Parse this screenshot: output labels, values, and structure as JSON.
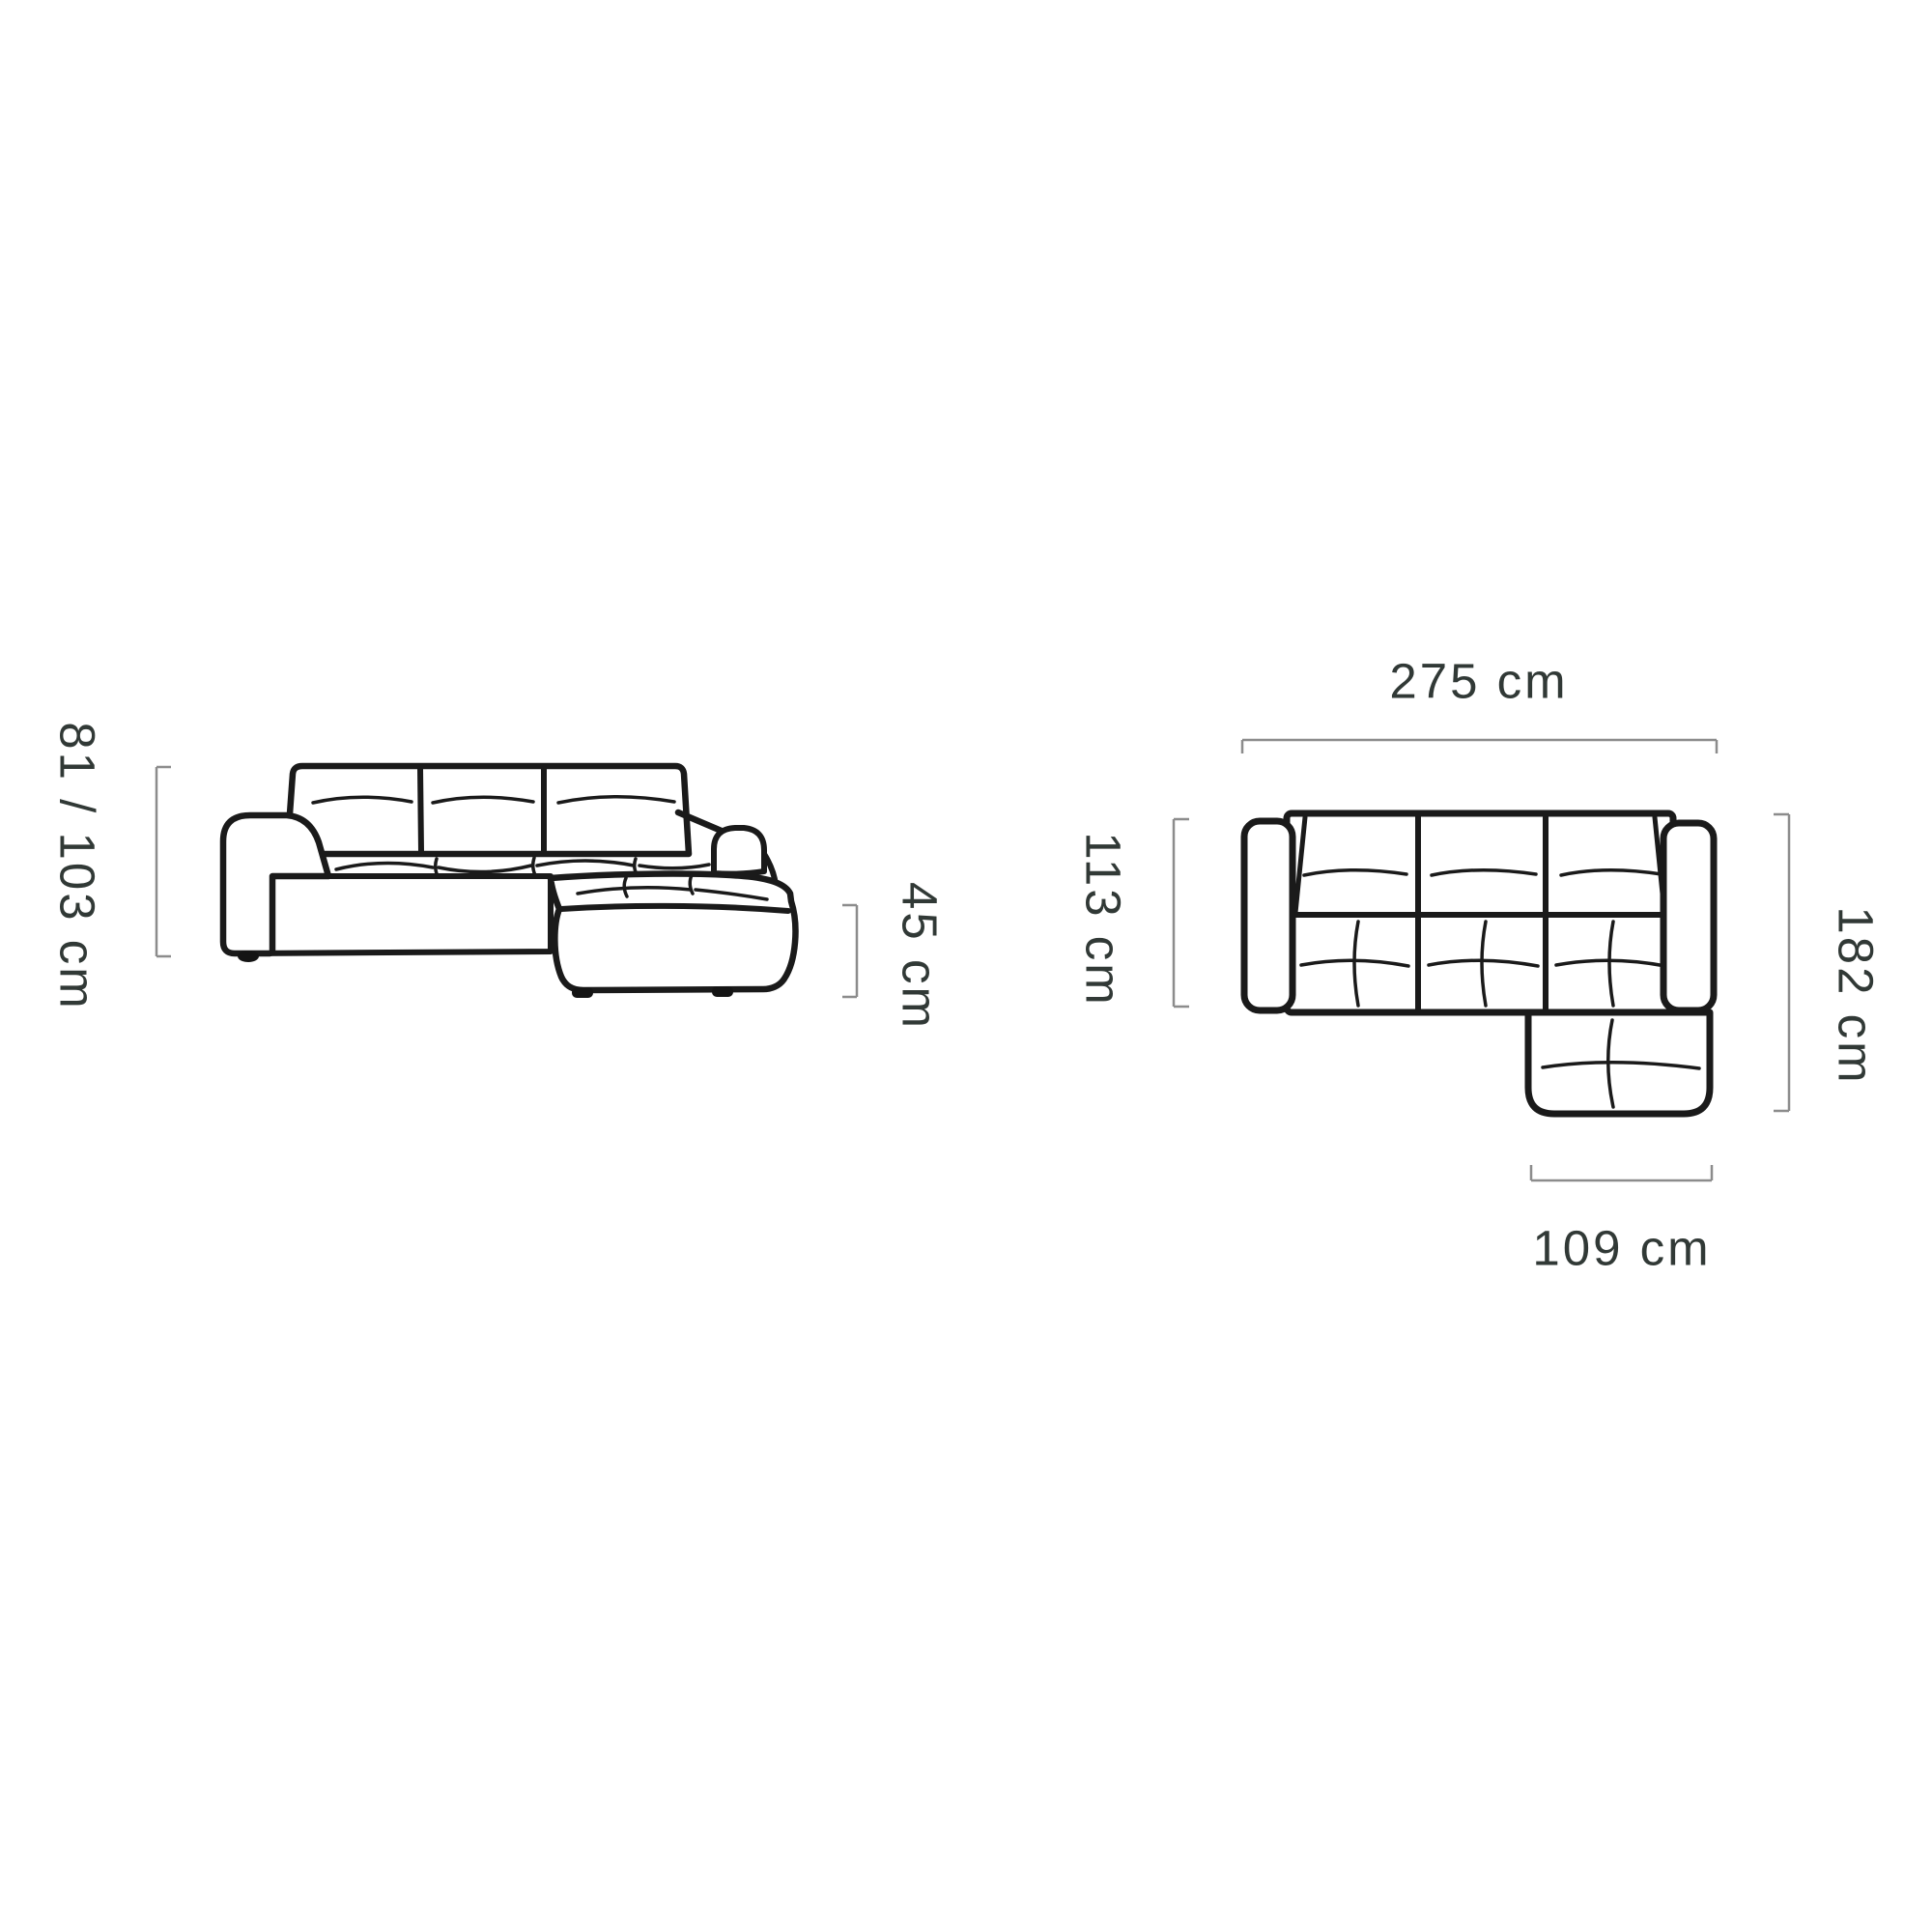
{
  "front_view": {
    "height_label": "81 / 103 cm",
    "seat_height_label": "45 cm"
  },
  "top_view": {
    "width_label": "275 cm",
    "depth_label": "113 cm",
    "total_depth_label": "182 cm",
    "chaise_width_label": "109 cm"
  },
  "dimensions": {
    "height_cm": "81 / 103",
    "seat_height_cm": 45,
    "width_cm": 275,
    "depth_cm": 113,
    "total_depth_cm": 182,
    "chaise_width_cm": 109
  },
  "colors": {
    "outline": "#1a1a1a",
    "dimension_line": "#8c8c8c",
    "label_text": "#313936",
    "background": "#ffffff"
  }
}
